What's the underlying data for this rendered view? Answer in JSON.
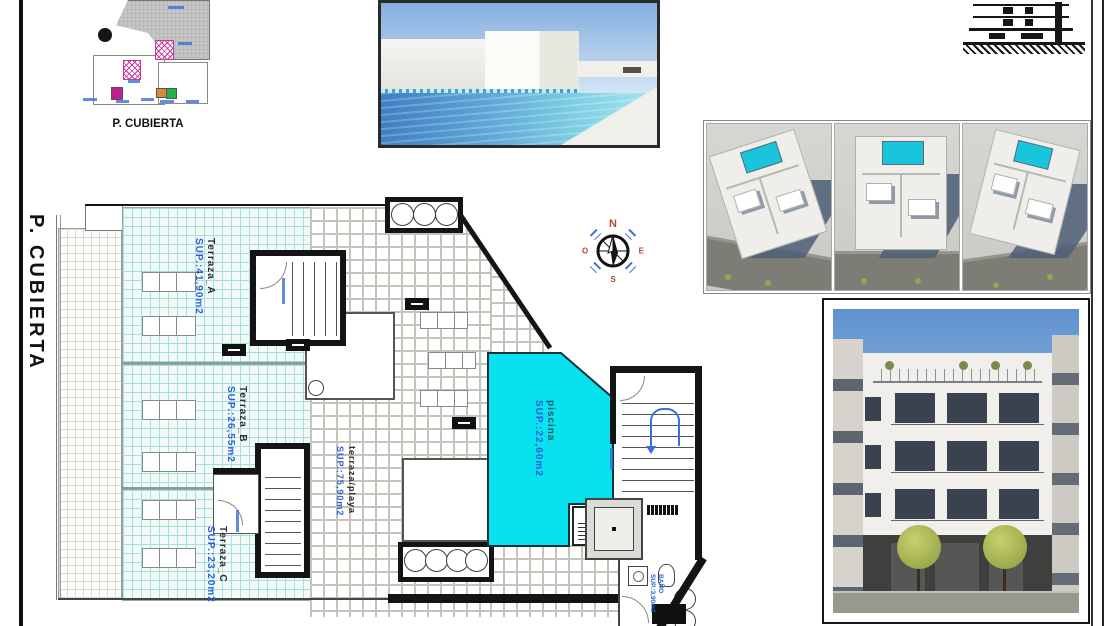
{
  "titles": {
    "sheet_vertical": "P. CUBIERTA",
    "site_plan_caption": "P. CUBIERTA"
  },
  "plan": {
    "areas": {
      "a": {
        "name": "Terraza_A",
        "sup": "SUP.:41,90m2"
      },
      "b": {
        "name": "Terraza_B",
        "sup": "SUP.:26,55m2"
      },
      "c": {
        "name": "Terraza_C",
        "sup": "SUP.:23,20m2"
      },
      "deck": {
        "name": "terraza/playa",
        "sup": "SUP.:75,90m2"
      },
      "pool": {
        "name": "piscina",
        "sup": "SUP.:22,60m2"
      },
      "bath": {
        "name": "BAÑO",
        "sup": "SUP.:3,90m2"
      }
    },
    "compass": {
      "n": "N",
      "e": "E",
      "s": "S",
      "o": "O"
    }
  },
  "colors": {
    "pool_fill": "#07e2ee",
    "tile_line_cyan": "#a6e0d8",
    "label_blue": "#2b5fd9",
    "hatch_magenta": "#c3399b",
    "render_pool": "#18c5da",
    "compass_letters": "#b5452e"
  }
}
